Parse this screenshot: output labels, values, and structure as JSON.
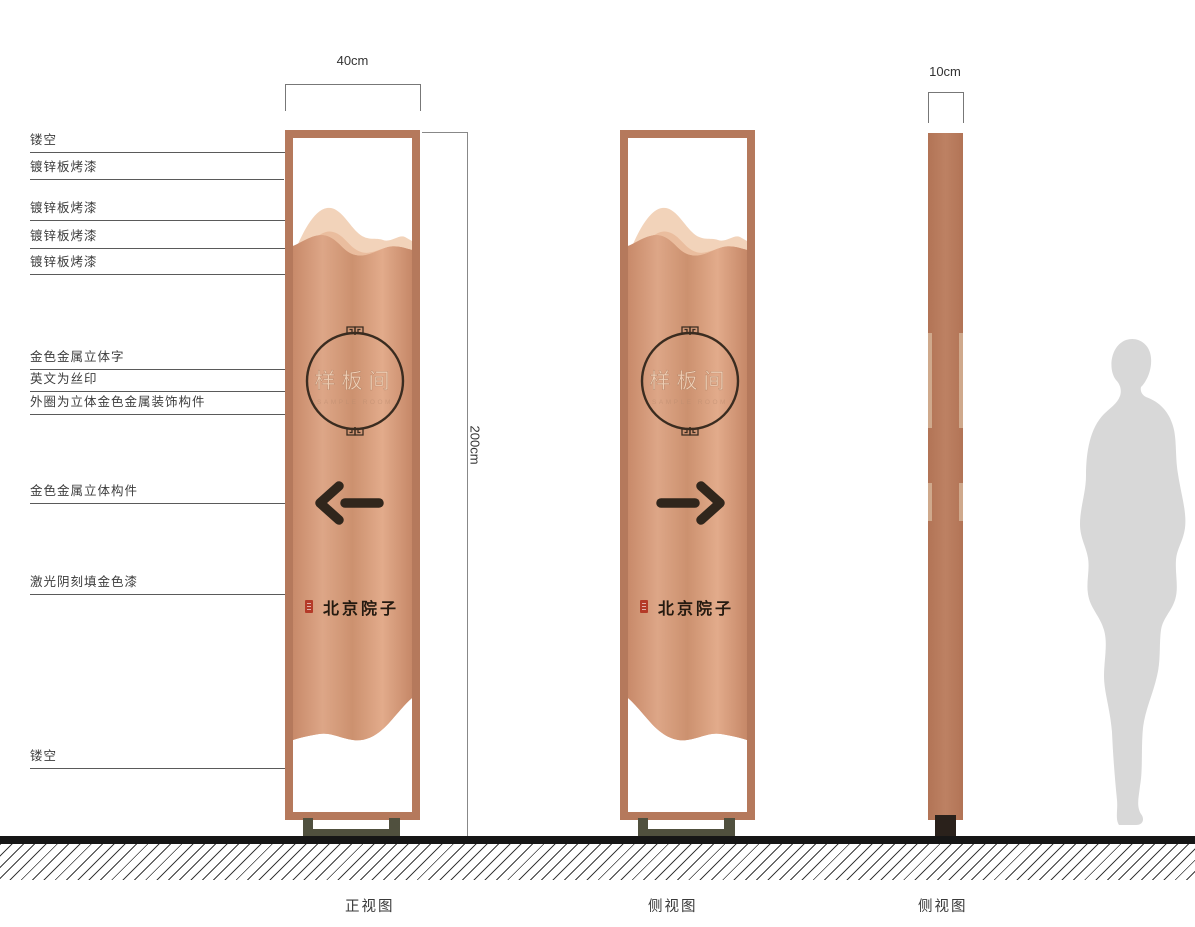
{
  "annotations": [
    {
      "text": "镂空"
    },
    {
      "text": "镀锌板烤漆"
    },
    {
      "text": "镀锌板烤漆"
    },
    {
      "text": "镀锌板烤漆"
    },
    {
      "text": "镀锌板烤漆"
    },
    {
      "text": "金色金属立体字"
    },
    {
      "text": "英文为丝印"
    },
    {
      "text": "外圈为立体金色金属装饰构件"
    },
    {
      "text": "金色金属立体构件"
    },
    {
      "text": "激光阴刻填金色漆"
    },
    {
      "text": "镂空"
    }
  ],
  "dimensions": {
    "front_width": "40cm",
    "height": "200cm",
    "side_width": "10cm"
  },
  "sign": {
    "room_label": "样板间",
    "room_label_en": "SAMPLE ROOM",
    "brand": "北京院子"
  },
  "captions": {
    "front_view": "正视图",
    "side_view_1": "侧视图",
    "side_view_2": "侧视图"
  },
  "colors": {
    "copper_frame": "#b5795c",
    "copper_light": "#e0ab8a",
    "copper_dark": "#c78a69",
    "mountain_back": "#f2d3ba",
    "mountain_mid": "#eabd9e",
    "accent_dark": "#30261c",
    "pedestal": "#50503e",
    "seal_red": "#b43a28",
    "silhouette": "#d8d8d8"
  }
}
